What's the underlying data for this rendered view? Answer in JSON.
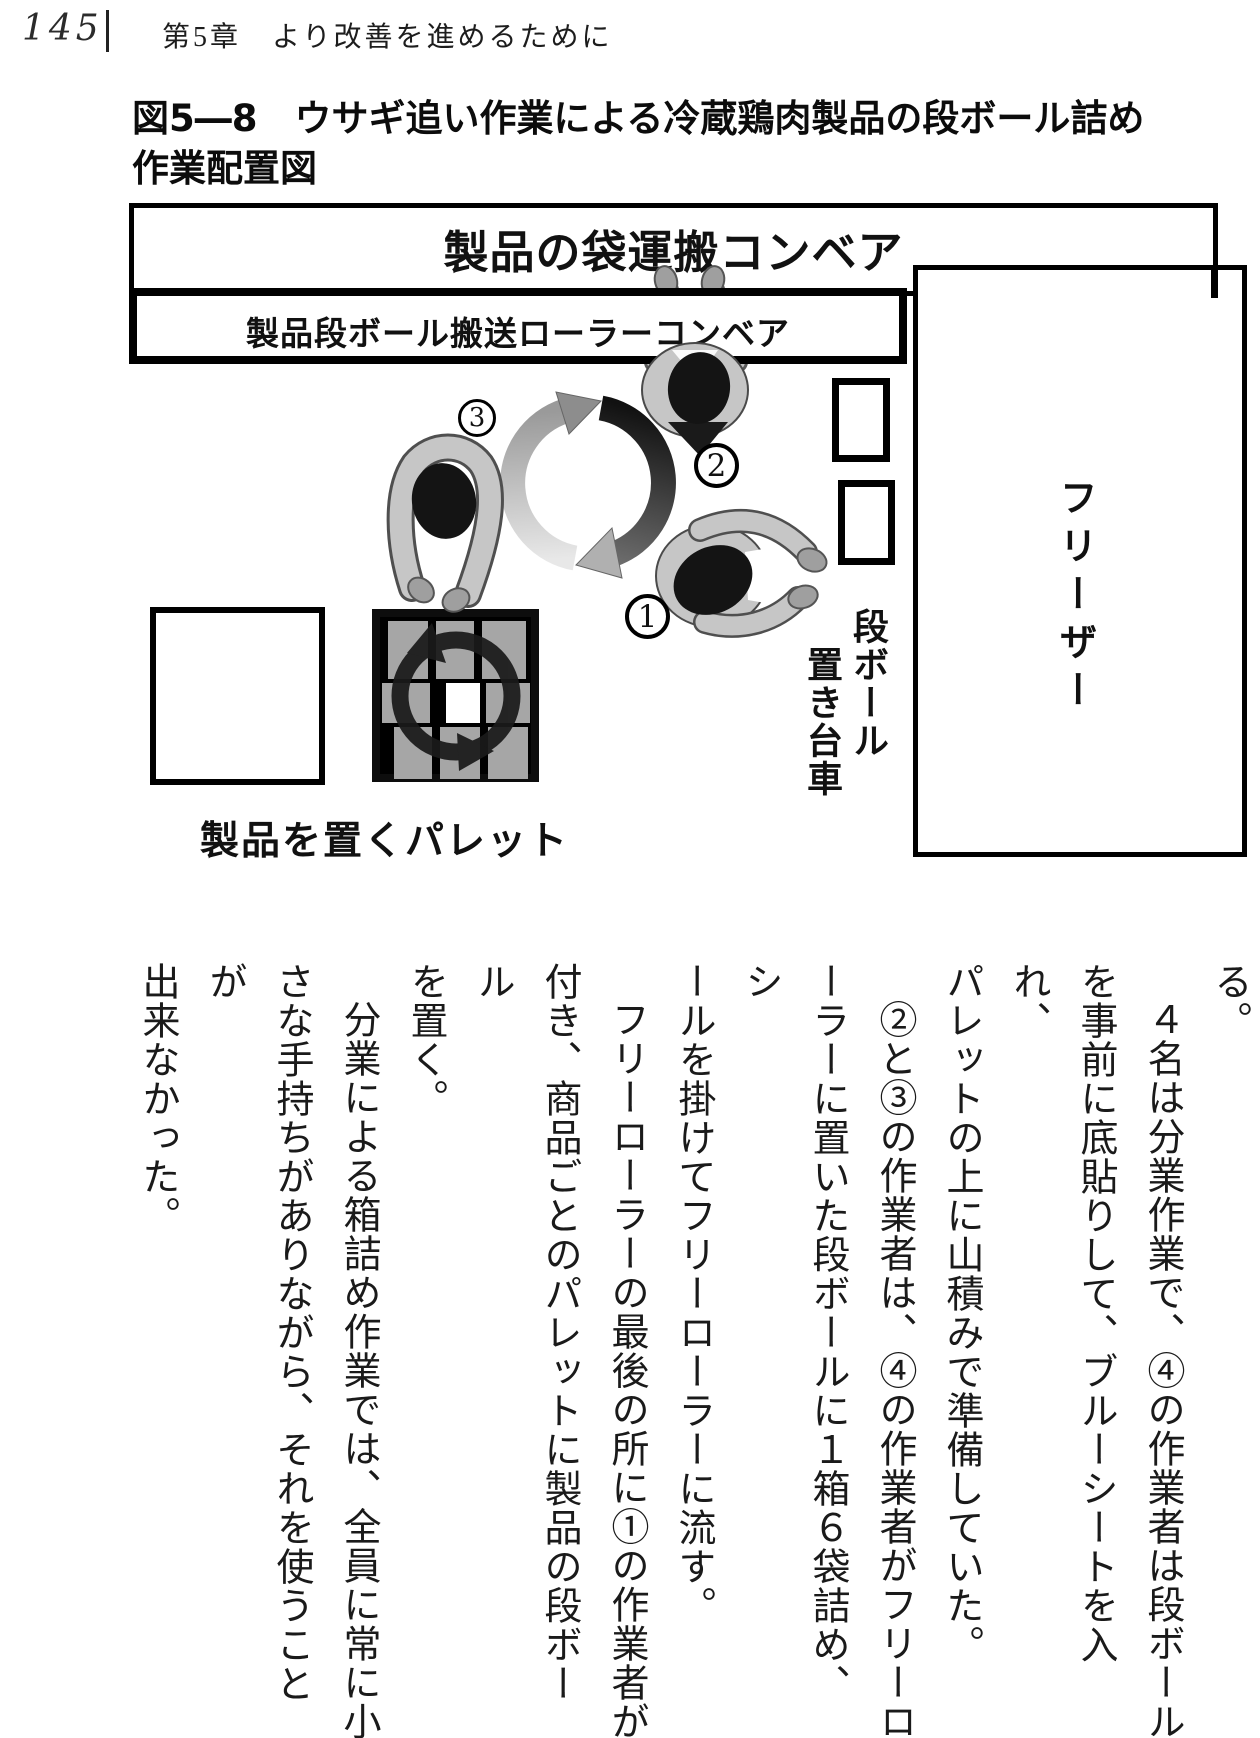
{
  "page": {
    "number": "145",
    "chapter": "第5章　より改善を進めるために"
  },
  "figure": {
    "title_line1": "図5―8　ウサギ追い作業による冷蔵鶏肉製品の段ボール詰め",
    "title_line2": "作業配置図",
    "labels": {
      "bag_conveyor": "製品の袋運搬コンベア",
      "roller_conveyor": "製品段ボール搬送ローラーコンベア",
      "freezer": "フリーザー",
      "cardboard_cart": "段ボール\n　置き台車",
      "pallet": "製品を置くパレット"
    },
    "markers": {
      "worker1": "1",
      "worker2": "2",
      "worker3": "3"
    }
  },
  "body": {
    "columns": [
      {
        "text": "る。"
      },
      {
        "text": "４名は分業作業で、④の作業者は段ボール",
        "indent": true
      },
      {
        "text": "を事前に底貼りして、ブルーシートを入れ、"
      },
      {
        "text": "パレットの上に山積みで準備していた。"
      },
      {
        "text": "②と③の作業者は、④の作業者がフリーロ",
        "indent": true
      },
      {
        "text": "ーラーに置いた段ボールに１箱６袋詰め、シ"
      },
      {
        "text": "ールを掛けてフリーローラーに流す。"
      },
      {
        "text": "フリーローラーの最後の所に①の作業者が",
        "indent": true
      },
      {
        "text": "付き、商品ごとのパレットに製品の段ボール"
      },
      {
        "text": "を置く。"
      },
      {
        "text": "分業による箱詰め作業では、全員に常に小",
        "indent": true
      },
      {
        "text": "さな手持ちがありながら、それを使うことが"
      },
      {
        "text": "出来なかった。"
      },
      {
        "text": "②改善後の３名によるウサギ追い作業",
        "indent": true
      },
      {
        "indent": true,
        "parts": [
          {
            "t": "「図5―8」",
            "b": true
          },
          {
            "t": "では作業者が３名付いている"
          }
        ]
      },
      {
        "text": "ように見えるが、それぞれの作業者が作業位"
      },
      {
        "text": "置を変え、この写真のように、段ボールを自"
      }
    ]
  },
  "colors": {
    "ink": "#1a1a1a",
    "line": "#000000",
    "worker_body": "#c6c6c6",
    "worker_head": "#141414",
    "carton_fill": "#a6a6a6",
    "arrow_dark": "#1f1f1f",
    "arrow_light": "#d9d9d9"
  }
}
